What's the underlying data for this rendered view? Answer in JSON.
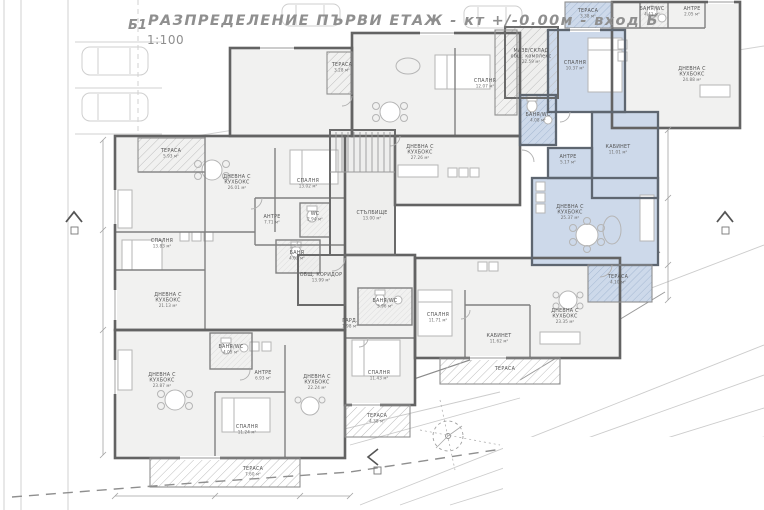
{
  "title": {
    "code": "Б1",
    "heading": "РАЗПРЕДЕЛЕНИЕ ПЪРВИ ЕТАЖ - кт +/-0.00м - вход Б",
    "scale": "1:100"
  },
  "colors": {
    "highlight_apartment": "#cdd9ea",
    "walls": "#636363",
    "room_text": "#545454",
    "title_text": "#8f8f8f"
  },
  "plan": {
    "rooms": [
      {
        "x": 342,
        "y": 66,
        "lines": [
          "ТЕРАСА",
          "3.28 м²"
        ]
      },
      {
        "x": 485,
        "y": 82,
        "lines": [
          "СПАЛНЯ",
          "12.07 м²"
        ]
      },
      {
        "x": 420,
        "y": 148,
        "lines": [
          "ДНЕВНА С",
          "КУХБОКС",
          "27.26 м²"
        ]
      },
      {
        "x": 531,
        "y": 52,
        "lines": [
          "МАЗЕ/СКЛАД",
          "общ. комплекс",
          "22.59 м²"
        ]
      },
      {
        "x": 588,
        "y": 12,
        "lines": [
          "ТЕРАСА",
          "3.38 м²"
        ],
        "hl": true
      },
      {
        "x": 652,
        "y": 10,
        "lines": [
          "БАНЯ/WC",
          "4.41 м²"
        ]
      },
      {
        "x": 692,
        "y": 10,
        "lines": [
          "АНТРЕ",
          "2.05 м²"
        ]
      },
      {
        "x": 575,
        "y": 64,
        "lines": [
          "СПАЛНЯ",
          "10.37 м²"
        ],
        "hl": true
      },
      {
        "x": 538,
        "y": 116,
        "lines": [
          "БАНЯ/WC",
          "4.08 м²"
        ],
        "hl": true
      },
      {
        "x": 568,
        "y": 158,
        "lines": [
          "АНТРЕ",
          "5.17 м²"
        ],
        "hl": true
      },
      {
        "x": 618,
        "y": 148,
        "lines": [
          "КАБИНЕТ",
          "11.01 м²"
        ],
        "hl": true
      },
      {
        "x": 570,
        "y": 208,
        "lines": [
          "ДНЕВНА С",
          "КУХБОКС",
          "25.37 м²"
        ],
        "hl": true
      },
      {
        "x": 618,
        "y": 278,
        "lines": [
          "ТЕРАСА",
          "4.10 м²"
        ],
        "hl": true
      },
      {
        "x": 692,
        "y": 70,
        "lines": [
          "ДНЕВНА С",
          "КУХБОКС",
          "24.88 м²"
        ]
      },
      {
        "x": 171,
        "y": 152,
        "lines": [
          "ТЕРАСА",
          "5.93 м²"
        ]
      },
      {
        "x": 237,
        "y": 178,
        "lines": [
          "ДНЕВНА С",
          "КУХБОКС",
          "26.01 м²"
        ]
      },
      {
        "x": 308,
        "y": 182,
        "lines": [
          "СПАЛНЯ",
          "13.02 м²"
        ]
      },
      {
        "x": 272,
        "y": 218,
        "lines": [
          "АНТРЕ",
          "7.71 м²"
        ]
      },
      {
        "x": 315,
        "y": 215,
        "lines": [
          "WC",
          "2.94 м²"
        ]
      },
      {
        "x": 297,
        "y": 254,
        "lines": [
          "БАНЯ",
          "4.03 м²"
        ]
      },
      {
        "x": 162,
        "y": 242,
        "lines": [
          "СПАЛНЯ",
          "13.83 м²"
        ]
      },
      {
        "x": 168,
        "y": 296,
        "lines": [
          "ДНЕВНА С",
          "КУХБОКС",
          "21.13 м²"
        ]
      },
      {
        "x": 372,
        "y": 214,
        "lines": [
          "СТЪЛБИЩЕ",
          "13.00 м²"
        ]
      },
      {
        "x": 321,
        "y": 276,
        "lines": [
          "ОБЩ. КОРИДОР",
          "13.99 м²"
        ]
      },
      {
        "x": 231,
        "y": 348,
        "lines": [
          "БАНЯ/WC",
          "4.05 м²"
        ]
      },
      {
        "x": 263,
        "y": 374,
        "lines": [
          "АНТРЕ",
          "6.93 м²"
        ]
      },
      {
        "x": 162,
        "y": 376,
        "lines": [
          "ДНЕВНА С",
          "КУХБОКС",
          "23.87 м²"
        ]
      },
      {
        "x": 247,
        "y": 428,
        "lines": [
          "СПАЛНЯ",
          "11.24 м²"
        ]
      },
      {
        "x": 253,
        "y": 470,
        "lines": [
          "ТЕРАСА",
          "7.60 м²"
        ]
      },
      {
        "x": 385,
        "y": 302,
        "lines": [
          "БАНЯ/WC",
          "3.96 м²"
        ]
      },
      {
        "x": 350,
        "y": 322,
        "lines": [
          "ГАРД.",
          "1.98 м²"
        ]
      },
      {
        "x": 317,
        "y": 378,
        "lines": [
          "ДНЕВНА С",
          "КУХБОКС",
          "22.24 м²"
        ]
      },
      {
        "x": 379,
        "y": 374,
        "lines": [
          "СПАЛНЯ",
          "11.43 м²"
        ]
      },
      {
        "x": 377,
        "y": 417,
        "lines": [
          "ТЕРАСА",
          "4.38 м²"
        ]
      },
      {
        "x": 438,
        "y": 316,
        "lines": [
          "СПАЛНЯ",
          "11.71 м²"
        ]
      },
      {
        "x": 499,
        "y": 337,
        "lines": [
          "КАБИНЕТ",
          "11.62 м²"
        ]
      },
      {
        "x": 565,
        "y": 312,
        "lines": [
          "ДНЕВНА С",
          "КУХБОКС",
          "23.35 м²"
        ]
      },
      {
        "x": 505,
        "y": 370,
        "lines": [
          "ТЕРАСА"
        ]
      }
    ]
  }
}
